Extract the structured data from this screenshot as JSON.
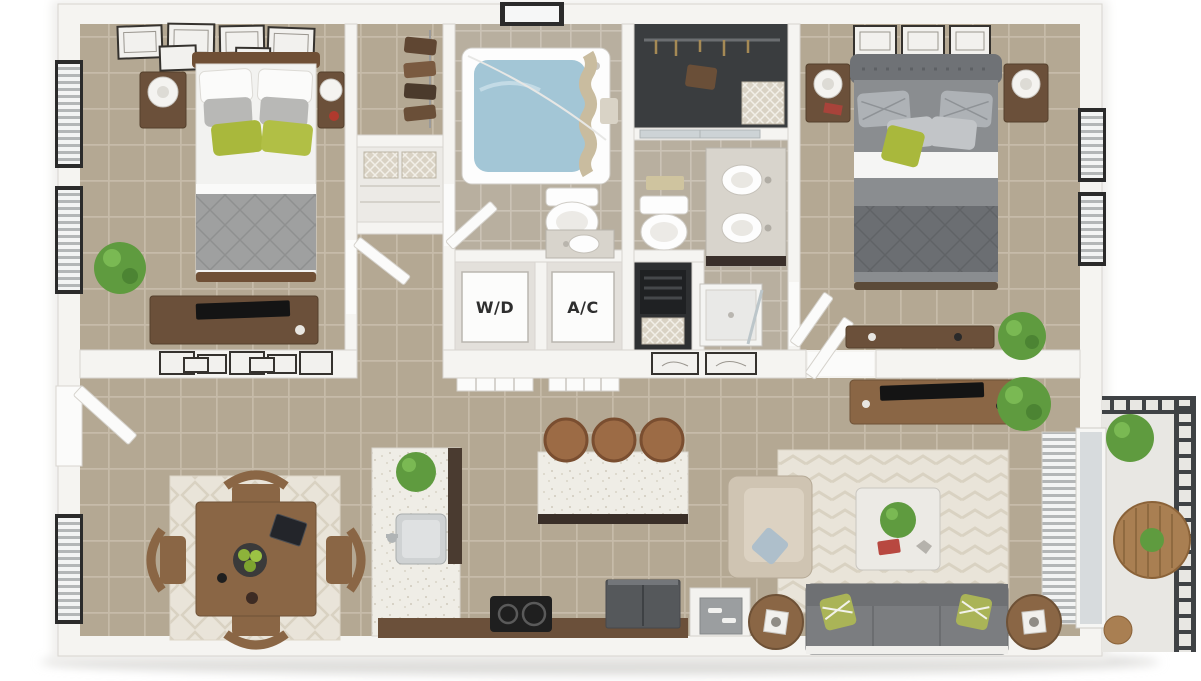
{
  "title": "3D apartment floor plan rendering",
  "labels": {
    "washer_dryer": "W/D",
    "air_conditioner": "A/C"
  },
  "palette": {
    "background": "#ffffff",
    "wall": "#f5f4f1",
    "wall_edge": "#d8d5d0",
    "floor_tile": "#b4a893",
    "bath_tile": "#b8af9f",
    "grout": "#c9bfad",
    "accent_green": "#a9b83c",
    "plant_green": "#5f9b3f",
    "wood": "#8a6645",
    "dark_wood": "#6b503a",
    "sofa_gray": "#7b7d80",
    "comforter_gray": "#9fa0a0",
    "water_blue": "#a3c6d6",
    "rug_cream": "#e9e4d9",
    "counter_speckle": "#efede6",
    "appliance_dark": "#55585b",
    "railing_dark": "#3f4245",
    "closet_dark": "#3a3d3f"
  }
}
